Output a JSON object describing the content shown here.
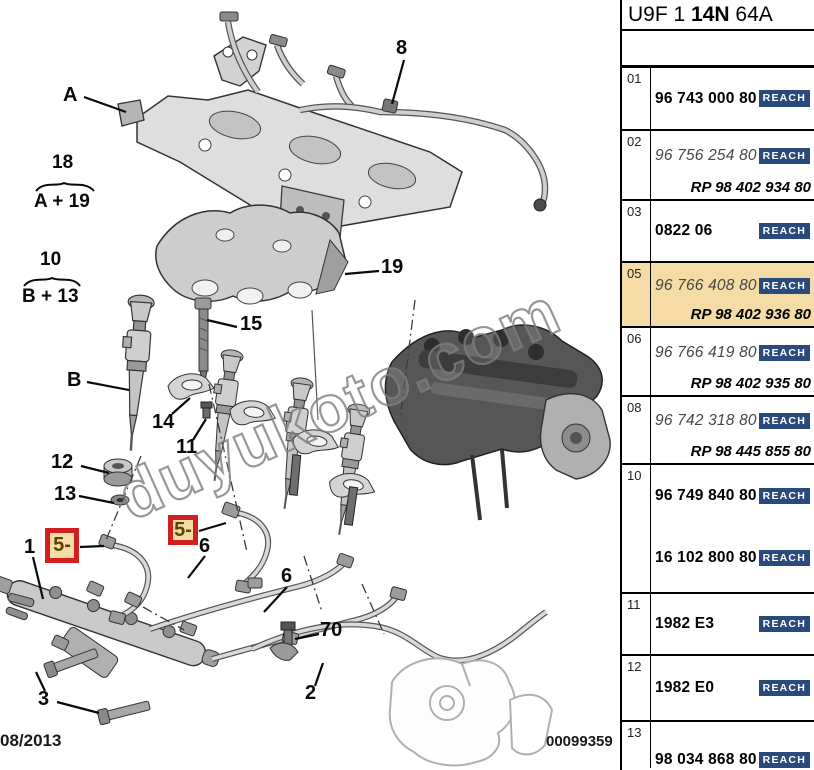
{
  "header": {
    "code_prefix": "U9F 1 ",
    "code_bold": "14N",
    "code_suffix": " 64A"
  },
  "diagram": {
    "watermark": "duyukoto.com",
    "date_stamp": "08/2013",
    "drawing_number": "00099359",
    "callouts": {
      "a": "A",
      "b": "B",
      "n1": "1",
      "n2": "2",
      "n3": "3",
      "n5": "5-",
      "n6": "6",
      "n8": "8",
      "n10": "10",
      "n11": "11",
      "n12": "12",
      "n13": "13",
      "n14": "14",
      "n15": "15",
      "n18": "18",
      "n19": "19",
      "n70": "70",
      "group_a19": "A + 19",
      "group_b13": "B + 13"
    }
  },
  "table": {
    "reach_label": "REACH",
    "rows": [
      {
        "num": "01",
        "part": "96 743 000 80",
        "style": "current"
      },
      {
        "num": "02",
        "part": "96 756 254 80",
        "rp": "RP 98 402 934 80",
        "style": "superseded"
      },
      {
        "num": "03",
        "part": "0822 06",
        "style": "current"
      },
      {
        "num": "05",
        "part": "96 766 408 80",
        "rp": "RP 98 402 936 80",
        "style": "superseded",
        "highlighted": true
      },
      {
        "num": "06",
        "part": "96 766 419 80",
        "rp": "RP 98 402 935 80",
        "style": "superseded"
      },
      {
        "num": "08",
        "part": "96 742 318 80",
        "rp": "RP 98 445 855 80",
        "style": "superseded"
      },
      {
        "num": "10",
        "part": "96 749 840 80",
        "part2": "16 102 800 80",
        "style": "current"
      },
      {
        "num": "11",
        "part": "1982 E3",
        "style": "current"
      },
      {
        "num": "12",
        "part": "1982 E0",
        "style": "current"
      },
      {
        "num": "13",
        "part": "98 034 868 80",
        "style": "current"
      }
    ]
  },
  "colors": {
    "highlight": "#f5dba6",
    "reach_badge_bg": "#2b4a7c",
    "callout_box_red": "#cf1f1f"
  }
}
